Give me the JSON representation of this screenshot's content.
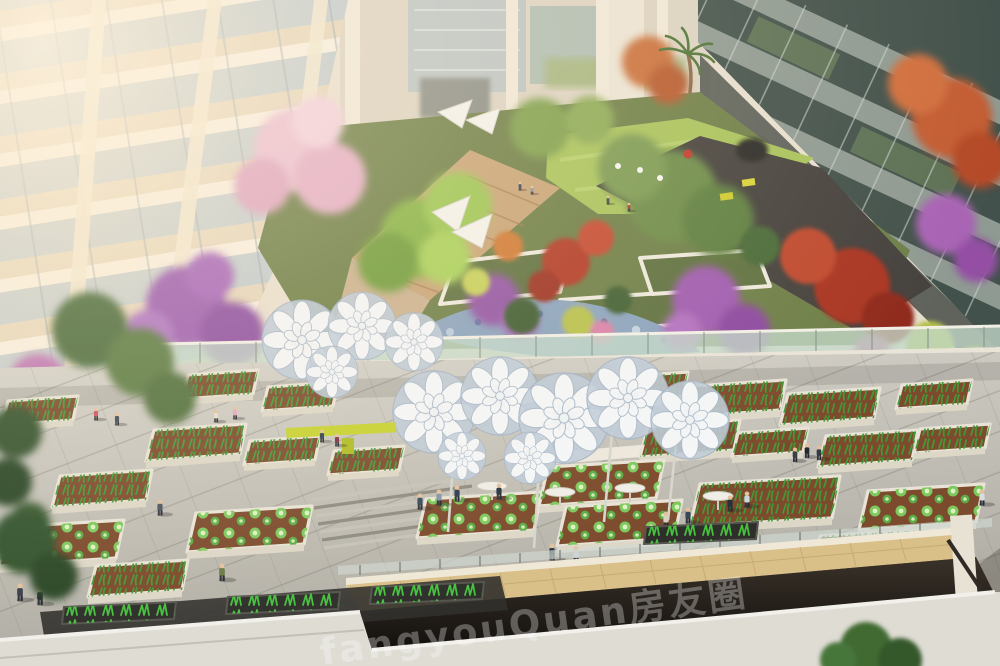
{
  "meta": {
    "kind": "architectural rendering",
    "description": "Aerial rendering of a residential courtyard: sunlit apartment building with balconies on the left, glass office facade on the right, a lush elevated garden with cherry-blossom, purple, red and green trees, a lawn with visitors, a stone stream, a glass balustrade, and a lower farming plaza with raised vegetable planters, white flower-shaped shade canopies, yellow benches, pedestrians and a sunken escalator opening with a beige tiled wall.",
    "width": 1000,
    "height": 666
  },
  "watermark": {
    "text": "fangyouQuan房友圈",
    "color": "rgba(255,255,255,0.30)"
  },
  "palette": {
    "left_building": "#efe2ca",
    "balcony_glass": "#b5c4ce",
    "right_facade_dark": "#42514b",
    "right_facade_frame": "#8f9a92",
    "atrium_wall": "#cfc8b8",
    "lawn_green": "#a9c35c",
    "dark_paving": "#45413d",
    "path_tan": "#c9a478",
    "cherry_pink": "#ecc0d2",
    "purple_bloom": "#9e5fb0",
    "red_foliage": "#b23a28",
    "orange_foliage": "#c96f3a",
    "bright_green_tree": "#86b344",
    "olive_tree": "#6d8c49",
    "stream_blue": "#8ba4be",
    "railing_glass": "#c3d8c9",
    "plaza_light": "#d3d0c8",
    "plaza_dark": "#aeaba2",
    "planter_soil": "#7c4a2c",
    "planter_edge": "#e8e3d6",
    "veg_green": "#3f9b35",
    "cabbage_green": "#7dc95e",
    "leek_green": "#46c03e",
    "canopy_white": "#f4f6f8",
    "canopy_blue": "#bfccda",
    "bench_yellow": "#c6d22f",
    "pit_wall": "#d9bf88",
    "pit_void": "#1c1712",
    "parapet": "#dfdcd4",
    "sun_glow": "#ffeed6"
  }
}
